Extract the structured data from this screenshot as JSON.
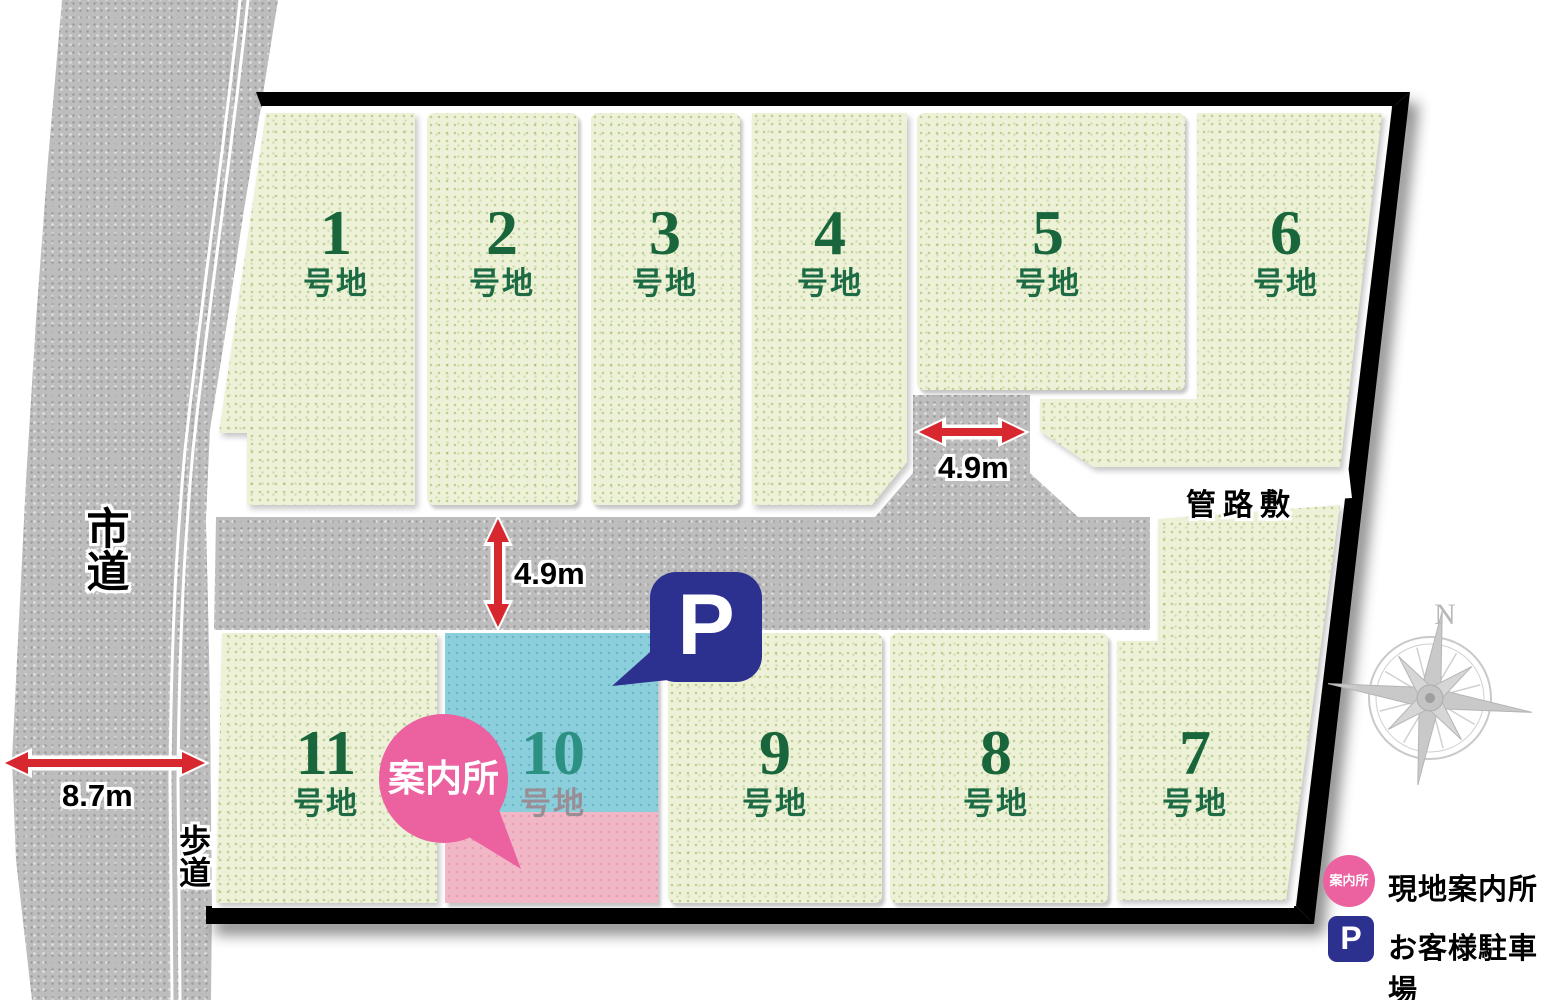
{
  "lots": [
    {
      "number": "1",
      "suffix": "号地"
    },
    {
      "number": "2",
      "suffix": "号地"
    },
    {
      "number": "3",
      "suffix": "号地"
    },
    {
      "number": "4",
      "suffix": "号地"
    },
    {
      "number": "5",
      "suffix": "号地"
    },
    {
      "number": "6",
      "suffix": "号地"
    },
    {
      "number": "7",
      "suffix": "号地"
    },
    {
      "number": "8",
      "suffix": "号地"
    },
    {
      "number": "9",
      "suffix": "号地"
    },
    {
      "number": "10",
      "suffix": "号地"
    },
    {
      "number": "11",
      "suffix": "号地"
    }
  ],
  "roads": {
    "city_road": "市道",
    "sidewalk": "歩道",
    "pipeline": "管路敷"
  },
  "dimensions": {
    "city_road_width": "8.7m",
    "main_road_width": "4.9m",
    "branch_road_width": "4.9m"
  },
  "markers": {
    "info_office": "案内所",
    "parking": "P"
  },
  "legend": {
    "items": [
      {
        "badge": "案内所",
        "label": "現地案内所"
      },
      {
        "badge": "P",
        "label": "お客様駐車場"
      }
    ]
  },
  "compass": {
    "north": "N"
  },
  "colors": {
    "lot_green": "#edf1d8",
    "road_gray": "#bdbdbd",
    "info_pink": "#ec619f",
    "parking_navy": "#2c3190",
    "lot10_blue": "#8ccfdc",
    "lot10_pink": "#f2b7c6",
    "number_green": "#1c6b44",
    "arrow_red": "#d7282f"
  }
}
